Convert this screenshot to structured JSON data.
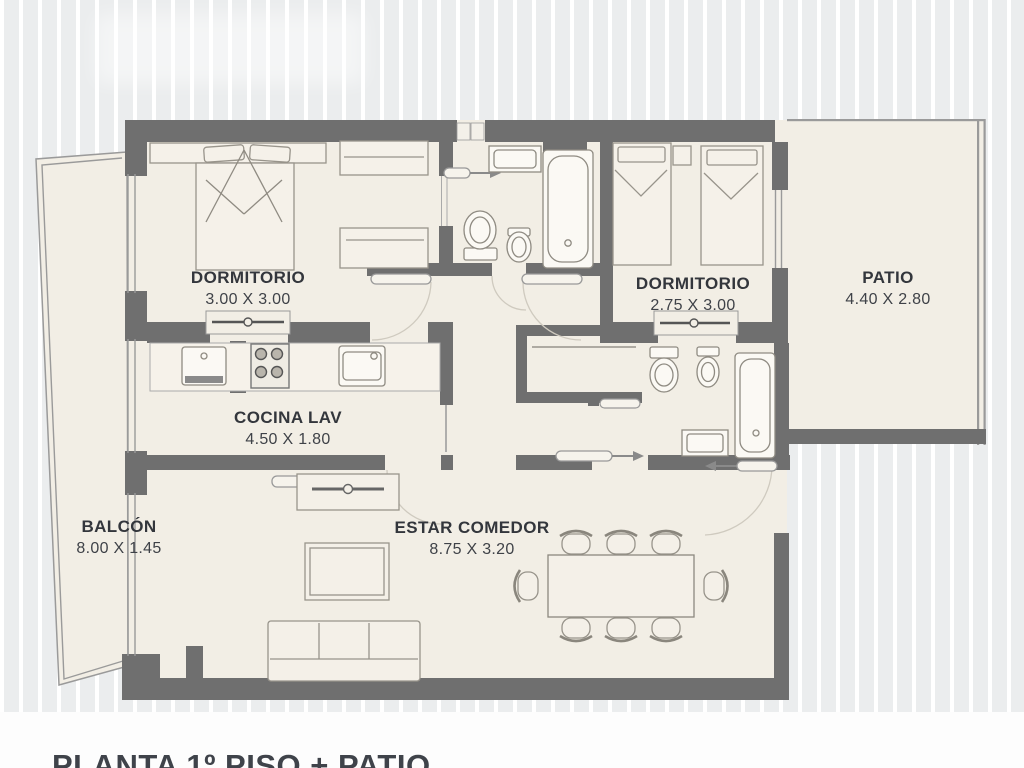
{
  "caption": "PLANTA 1º PISO + PATIO",
  "rooms": {
    "dormitorio1": {
      "name": "DORMITORIO",
      "dims": "3.00 X 3.00"
    },
    "dormitorio2": {
      "name": "DORMITORIO",
      "dims": "2.75 X 3.00"
    },
    "patio": {
      "name": "PATIO",
      "dims": "4.40 X 2.80"
    },
    "cocina": {
      "name": "COCINA LAV",
      "dims": "4.50 X 1.80"
    },
    "balcon": {
      "name": "BALCÓN",
      "dims": "8.00 X 1.45"
    },
    "estar": {
      "name": "ESTAR COMEDOR",
      "dims": "8.75 X 3.20"
    }
  },
  "colors": {
    "background": "#ebedee",
    "floor": "#f2eee5",
    "wall": "#6f6f6f",
    "thin_line": "#9a9a9a",
    "text": "#33363c"
  }
}
